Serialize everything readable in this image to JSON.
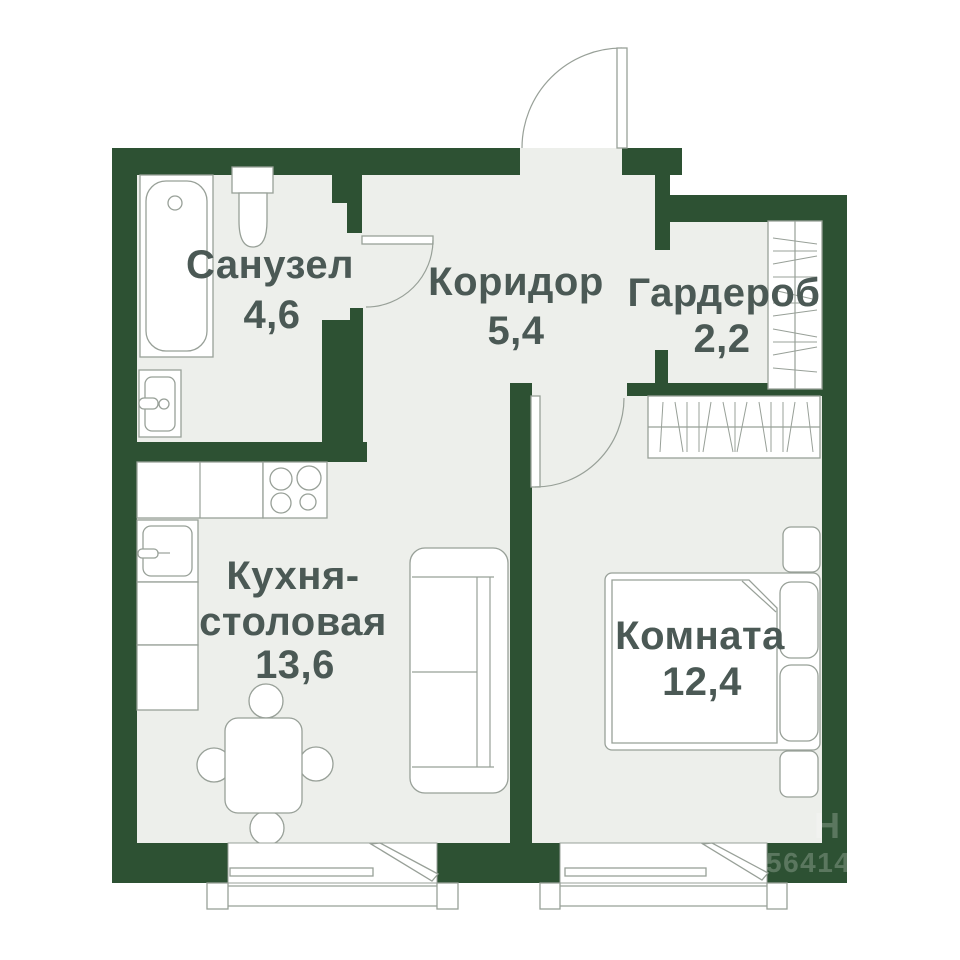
{
  "plan": {
    "rooms": [
      {
        "id": "bathroom",
        "label": "Санузел",
        "area": "4,6"
      },
      {
        "id": "corridor",
        "label": "Коридор",
        "area": "5,4"
      },
      {
        "id": "wardrobe",
        "label": "Гардероб",
        "area": "2,2"
      },
      {
        "id": "kitchen",
        "label_line1": "Кухня-",
        "label_line2": "столовая",
        "area": "13,6"
      },
      {
        "id": "room",
        "label": "Комната",
        "area": "12,4"
      }
    ],
    "watermark": {
      "line1": "Н",
      "line2": "56414"
    },
    "colors": {
      "wall": "#2d5133",
      "floor": "#edefeb",
      "outline": "#98a098",
      "text": "#4b5955",
      "background": "#ffffff"
    }
  }
}
